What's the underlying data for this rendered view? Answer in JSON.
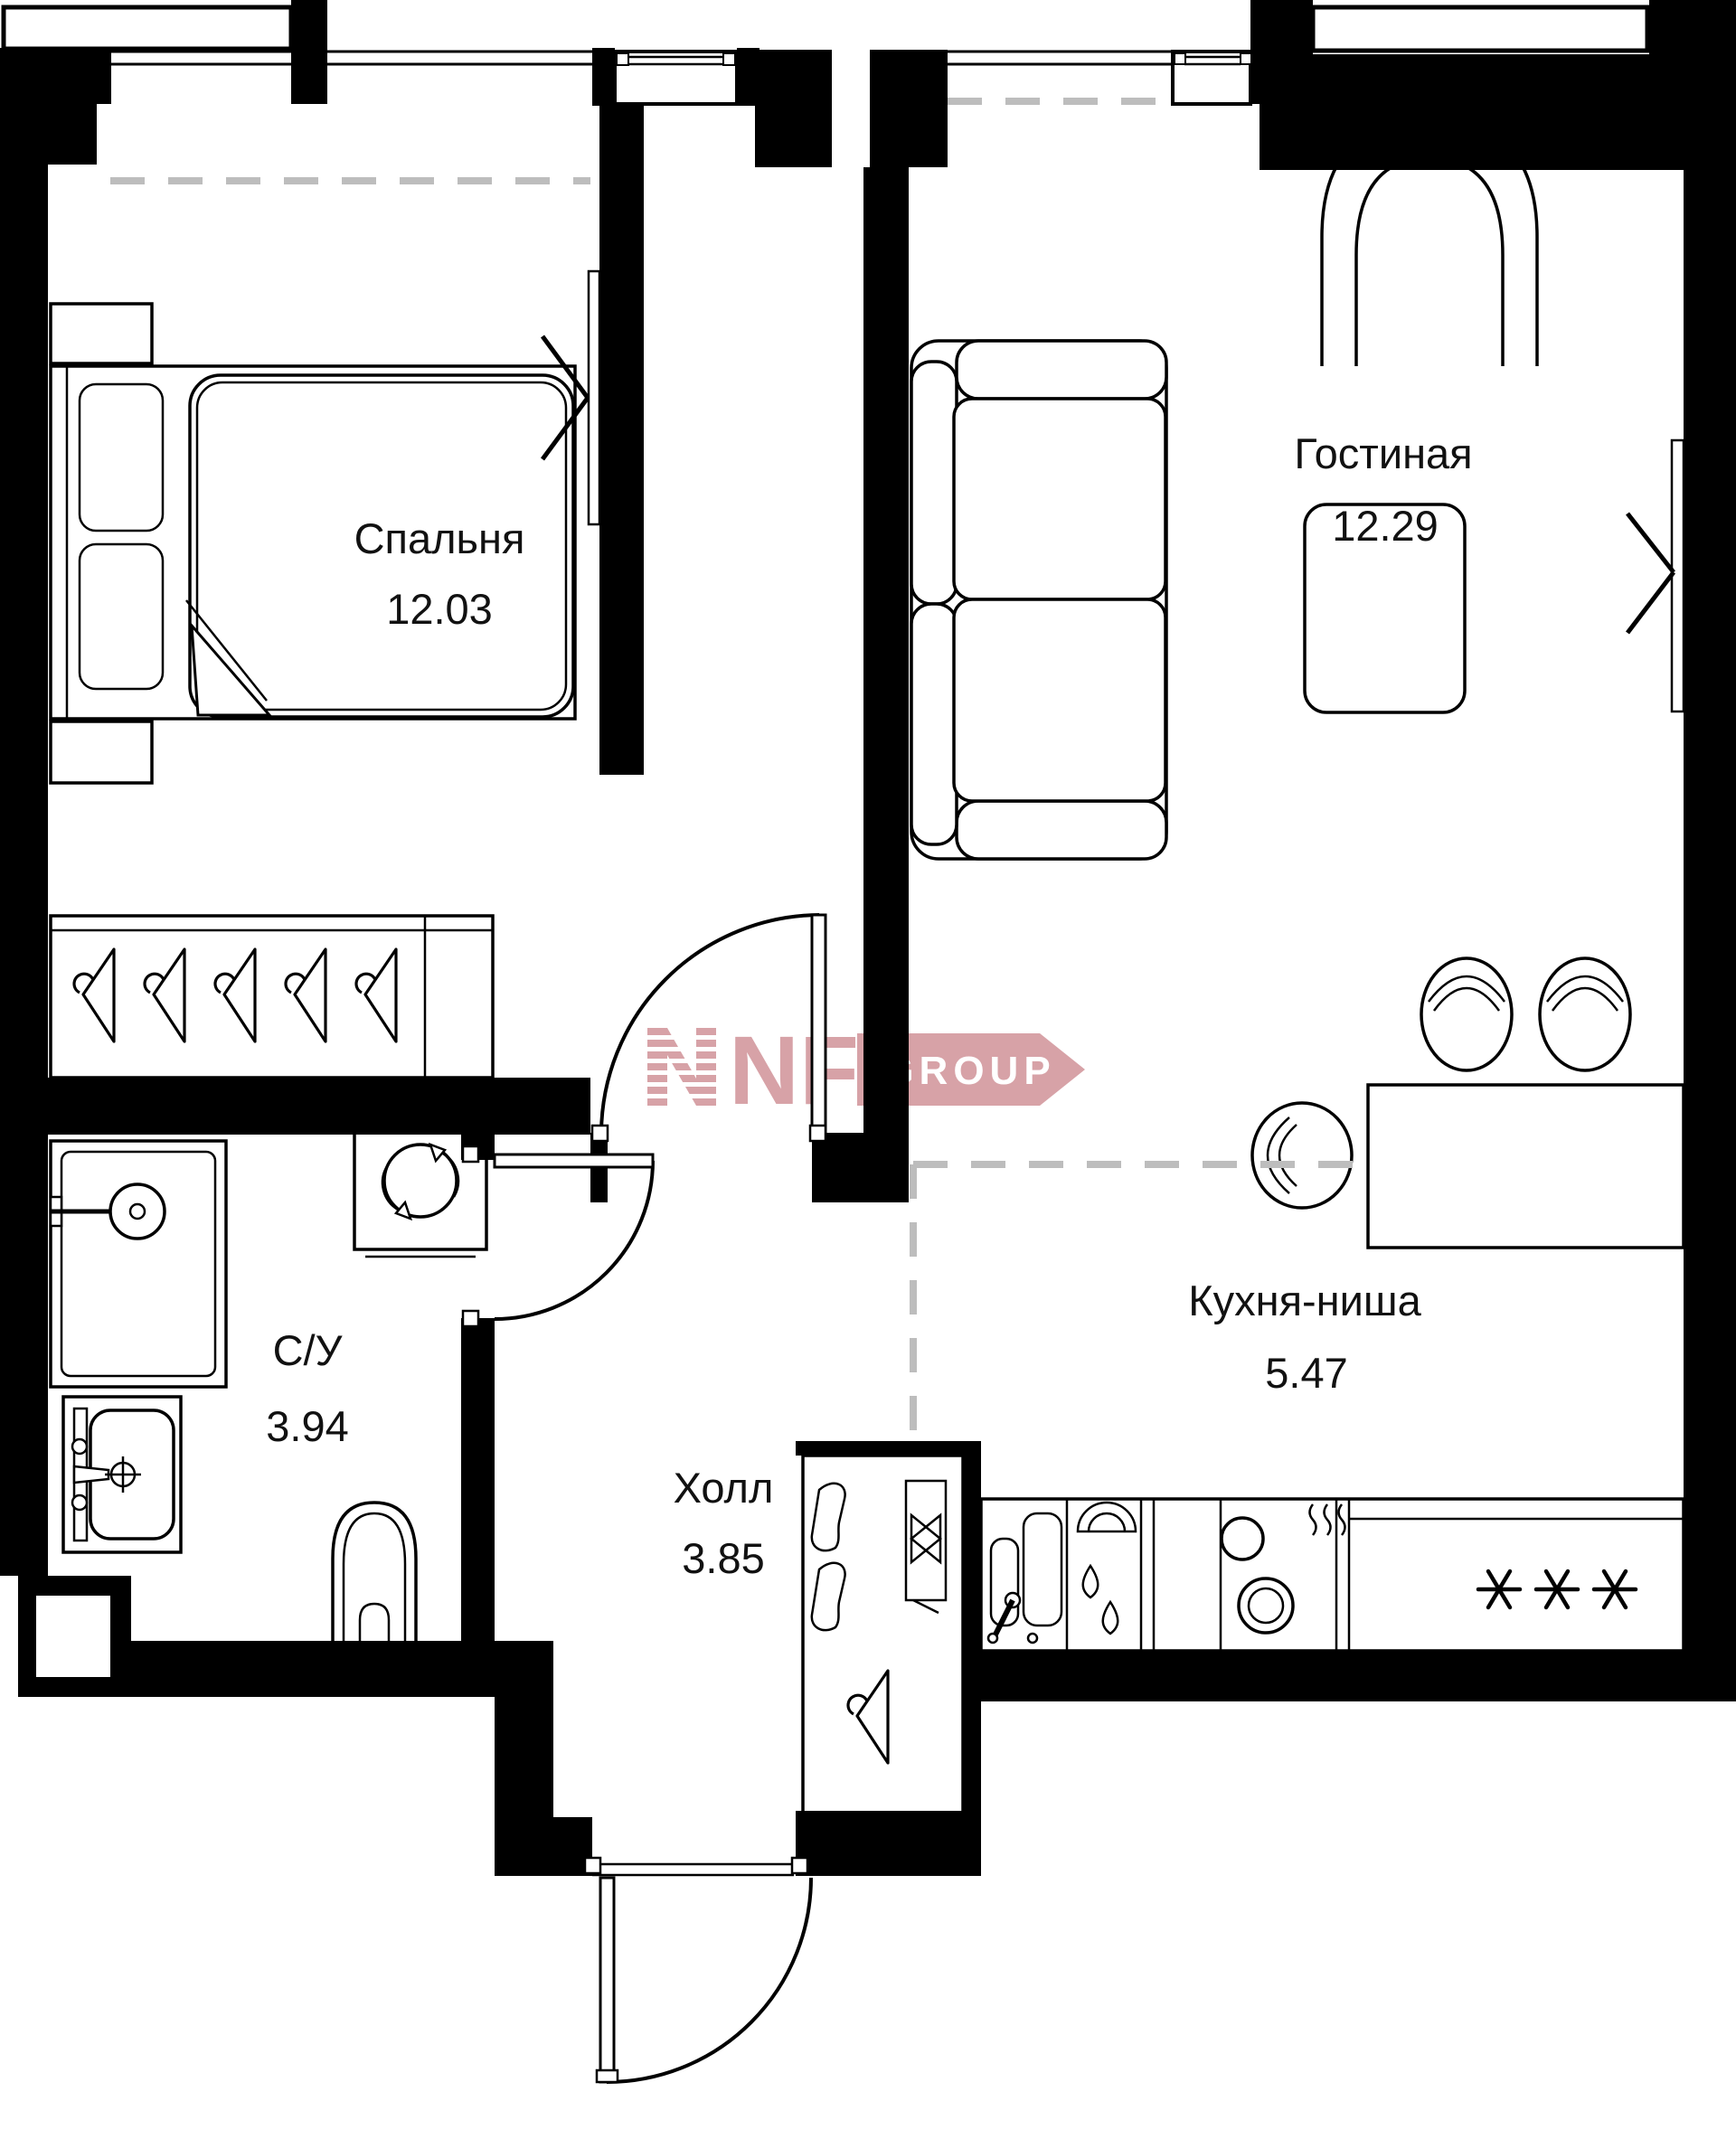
{
  "plan": {
    "rooms": [
      {
        "name": "Спальня",
        "area": "12.03"
      },
      {
        "name": "Гостиная",
        "area": "12.29"
      },
      {
        "name": "Кухня-ниша",
        "area": "5.47"
      },
      {
        "name": "С/У",
        "area": "3.94"
      },
      {
        "name": "Холл",
        "area": "3.85"
      }
    ],
    "logo": {
      "letters": "NF",
      "suffix": "GROUP",
      "color": "#d7a2a7",
      "text_color": "#ffffff"
    },
    "colors": {
      "wall": "#000000",
      "line": "#000000",
      "zone_dash": "#bdbdbd",
      "background": "#ffffff"
    }
  }
}
